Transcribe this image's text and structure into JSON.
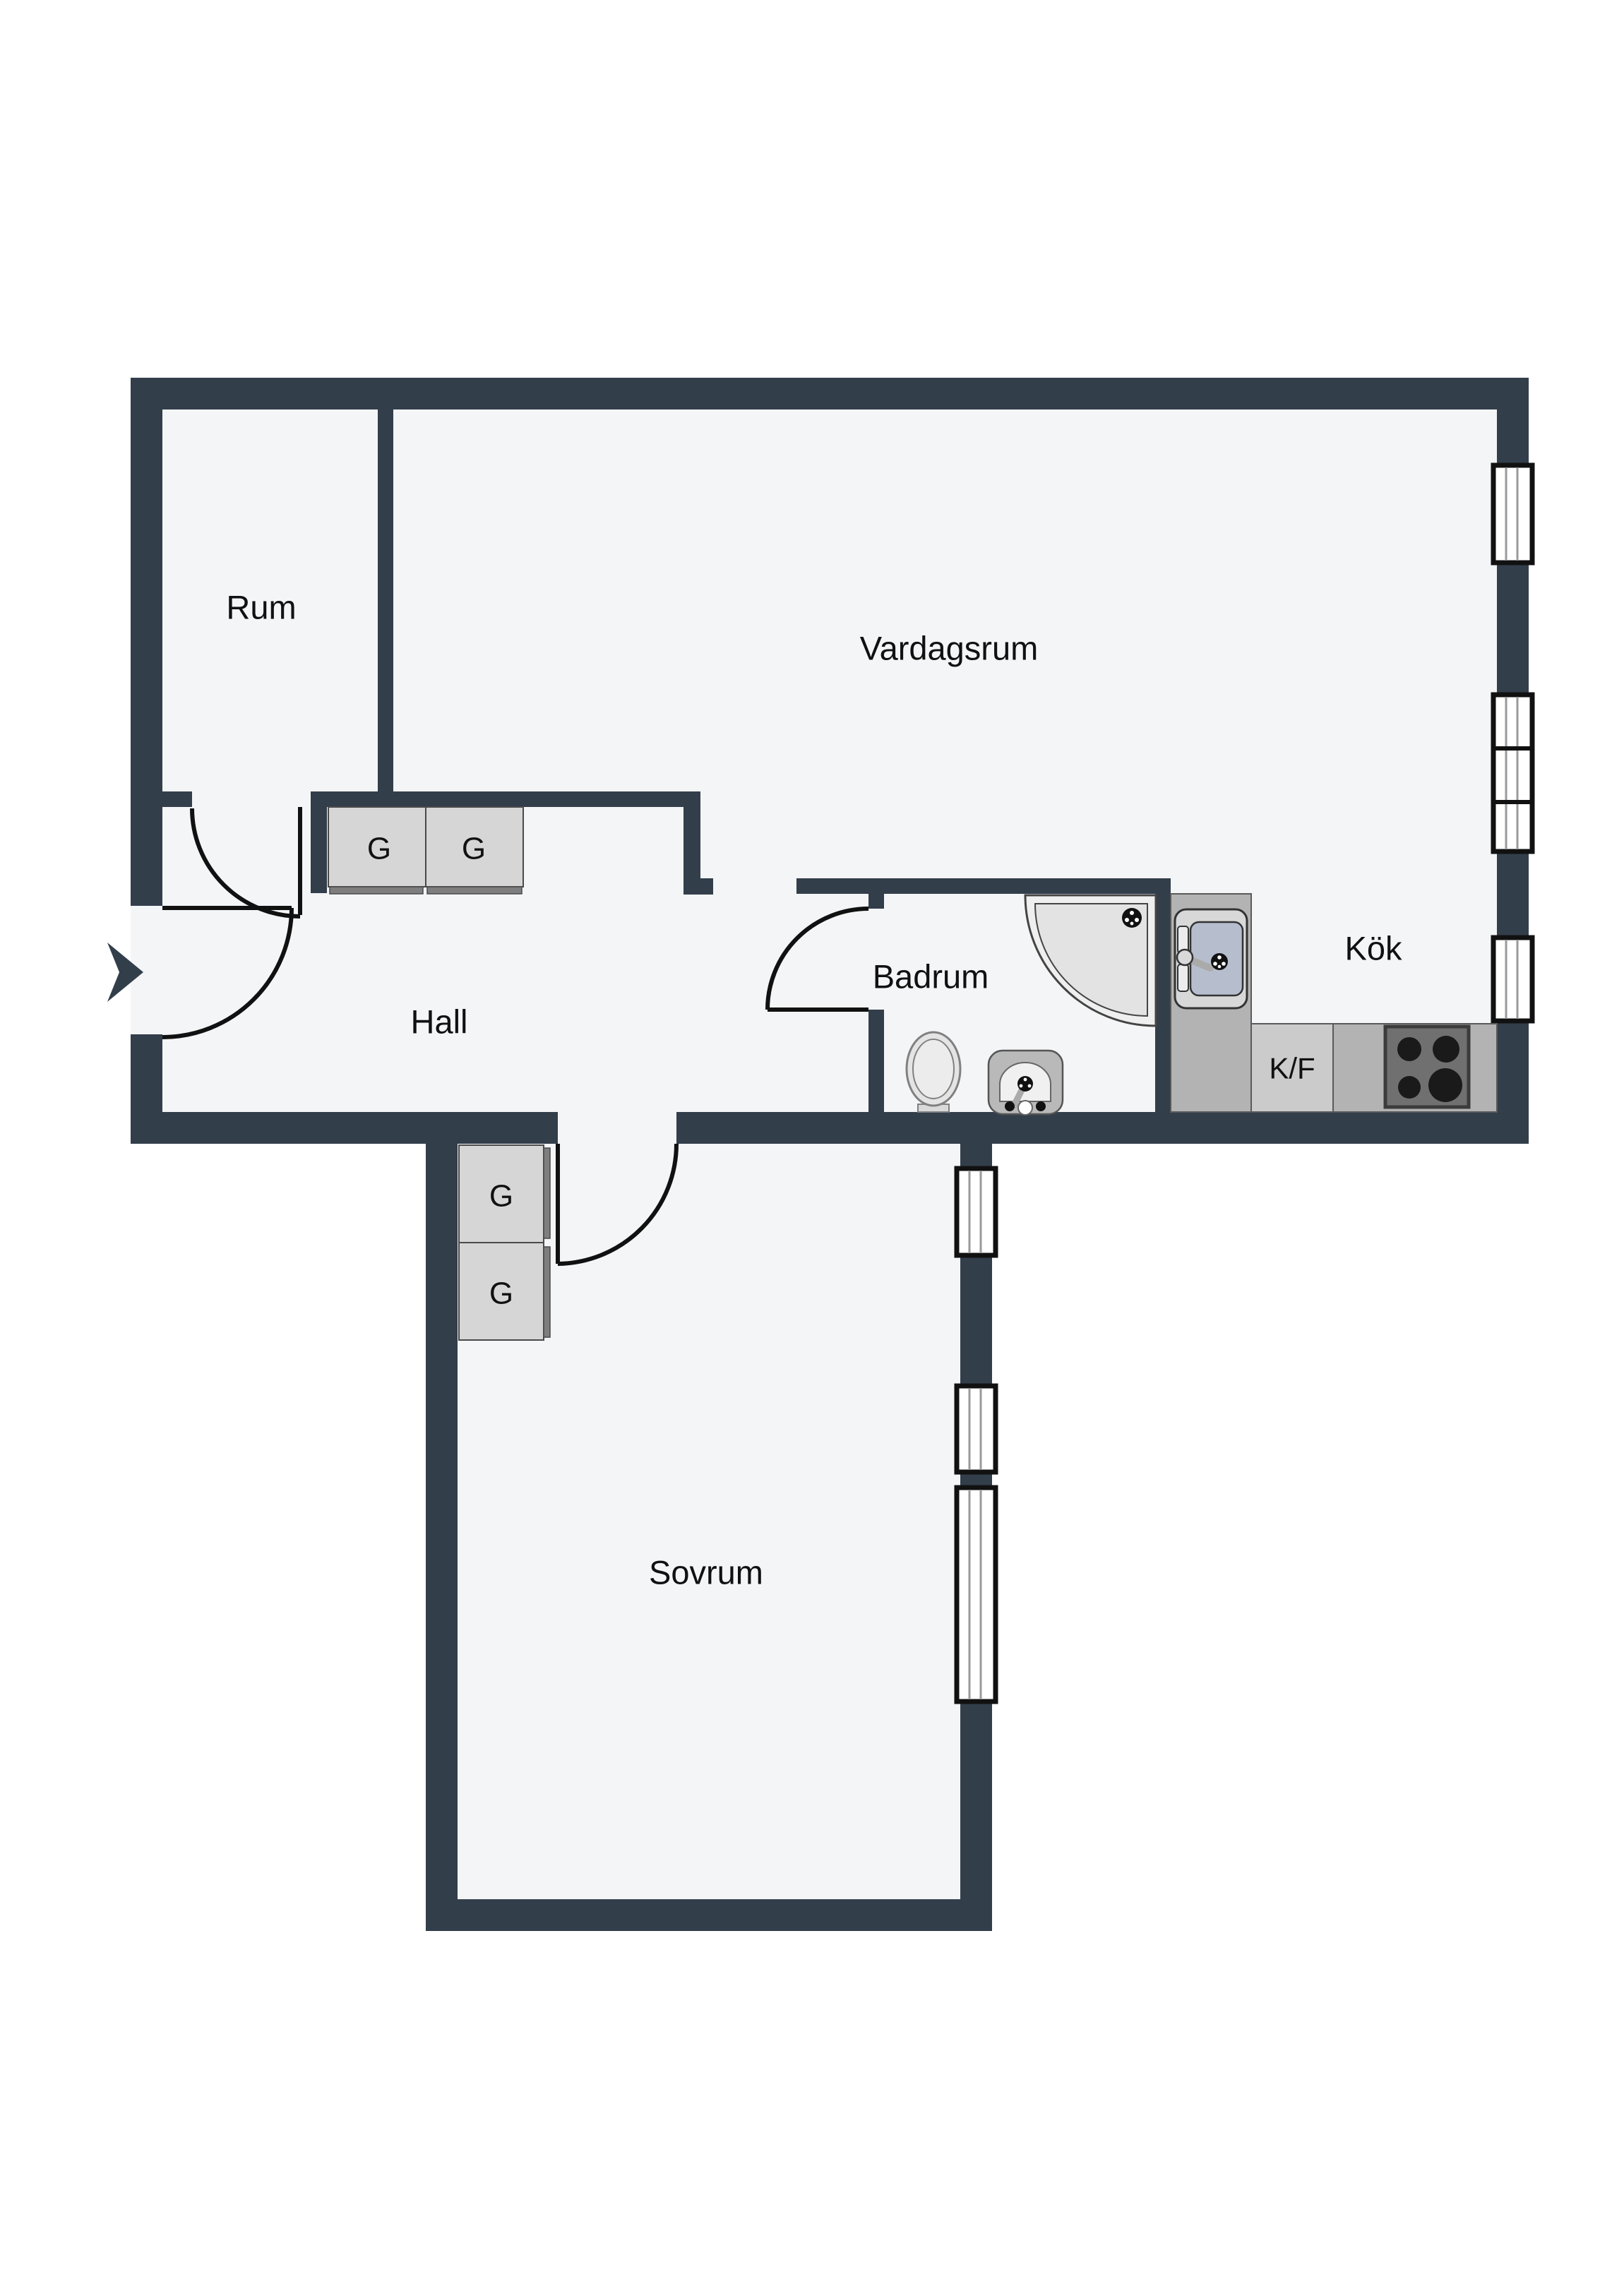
{
  "plan": {
    "type": "apartment-floor-plan",
    "colors": {
      "wall": "#333e4b",
      "floor": "#f4f5f7",
      "background": "#ffffff",
      "counter": "#b3b3b3",
      "counter_light": "#cbcbcb",
      "wardrobe": "#d6d6d6",
      "wardrobe_front": "#7e7e7e",
      "sink_basin": "#b6bece",
      "stove": "#707070",
      "burner": "#1a1a1a",
      "fixture_light": "#e9e9e9",
      "door_line": "#111111"
    },
    "rooms": {
      "rum": {
        "label": "Rum"
      },
      "vardagsrum": {
        "label": "Vardagsrum"
      },
      "hall": {
        "label": "Hall"
      },
      "badrum": {
        "label": "Badrum"
      },
      "kok": {
        "label": "Kök"
      },
      "sovrum": {
        "label": "Sovrum"
      }
    },
    "kitchen": {
      "fridge_freezer_label": "K/F",
      "fixtures": [
        "kitchen-sink",
        "fridge-freezer",
        "stove-4-burners"
      ]
    },
    "bathroom": {
      "fixtures": [
        "corner-shower",
        "toilet",
        "washbasin"
      ]
    },
    "wardrobes": {
      "label": "G",
      "hall_units": 2,
      "sovrum_units": 2
    },
    "windows": {
      "living_room_east_wall": 3,
      "bedroom_east_wall": 3
    },
    "entrance": {
      "marker": "entry-arrow"
    }
  }
}
